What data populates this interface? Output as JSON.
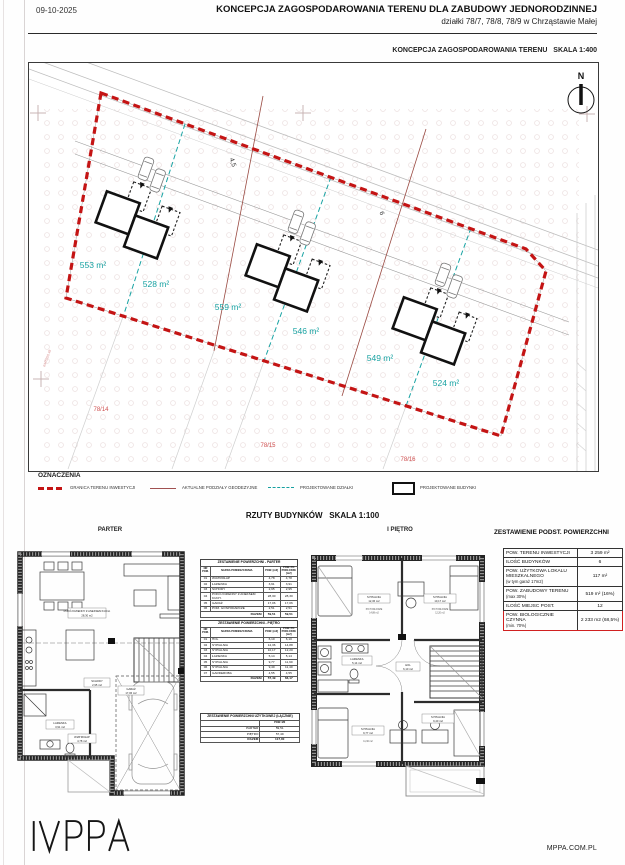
{
  "header": {
    "date": "09-10-2025",
    "title": "KONCEPCJA ZAGOSPODAROWANIA TERENU DLA ZABUDOWY JEDNORODZINNEJ",
    "subtitle": "działki 78/7, 78/8, 78/9  w Chrząstawie Małej"
  },
  "site_plan": {
    "caption": "KONCEPCJA ZAGOSPODAROWANIA TERENU",
    "scale": "SKALA 1:400",
    "north_label": "N",
    "plot_areas": [
      "553 m²",
      "528 m²",
      "559 m²",
      "546 m²",
      "549 m²",
      "524 m²"
    ],
    "parcel_labels": [
      "78/14",
      "78/15",
      "78/16"
    ],
    "dimensions": [
      "4,5",
      "6"
    ],
    "survey_coord": "6445250.48"
  },
  "legend": {
    "title": "OZNACZENIA",
    "items": [
      {
        "label": "GRANICA TERENU INWESTYCJI"
      },
      {
        "label": "AKTUALNE PODZIAŁY GEODEZYJNE"
      },
      {
        "label": "PROJEKTOWANE DZIAŁKI"
      },
      {
        "label": "PROJEKTOWANE BUDYNKI"
      }
    ]
  },
  "floor_plans": {
    "section_title": "RZUTY BUDYNKÓW",
    "scale": "SKALA 1:100",
    "left_title": "PARTER",
    "right_title": "I PIĘTRO",
    "parter_labels": [
      {
        "name": "POKÓJ DZIENNY Z ANEKSEM KUCH.",
        "area": "28,30 m2"
      },
      {
        "name": "SCHODY",
        "area": "2,95 m2"
      },
      {
        "name": "ŁAZIENKA",
        "area": "3,91 m2"
      },
      {
        "name": "WIATROŁAP",
        "area": "4,78 m2"
      },
      {
        "name": "GARAŻ",
        "area": "17,06 m2"
      }
    ],
    "pietro_labels": [
      {
        "name": "SYPIALNIA",
        "area": "12,36 m2",
        "sub1": "PO PODŁODZE",
        "sub2": "14,88 m2"
      },
      {
        "name": "SYPIALNIA",
        "area": "10,17 m2",
        "sub1": "PO PODŁODZE",
        "sub2": "12,20 m2"
      },
      {
        "name": "ŁAZIENKA",
        "area": "5,14 m2",
        "sub1": "",
        "sub2": ""
      },
      {
        "name": "HOL",
        "area": "6,10 m2",
        "sub1": "",
        "sub2": ""
      },
      {
        "name": "SYPIALNIA",
        "area": "9,77 m2",
        "sub1": "PO PODŁODZE",
        "sub2": "11,90 m2"
      },
      {
        "name": "SYPIALNIA",
        "area": "9,40 m2",
        "sub1": "PO PODŁODZE",
        "sub2": "11,40 m2"
      }
    ]
  },
  "room_tables": {
    "parter": {
      "title": "ZESTAWIENIE POWIERZCHNI - PARTER",
      "columns": [
        "NR POM.",
        "NAZWA POMIESZCZENIA",
        "POW. [m2]",
        "POW. PO PODŁODZE [m2]"
      ],
      "rows": [
        [
          "01",
          "WIATROŁAP",
          "4,78",
          "4,78"
        ],
        [
          "02",
          "ŁAZIENKA",
          "3,91",
          "3,91"
        ],
        [
          "03",
          "SCHODY",
          "2,95",
          "2,95"
        ],
        [
          "04",
          "POKÓJ DZIENNY Z ANEKSEM KUCH.",
          "28,30",
          "28,30"
        ],
        [
          "05",
          "GARAŻ",
          "17,06",
          "17,06"
        ],
        [
          "06",
          "POM. GOSPODARCZE",
          "2,51",
          "2,51"
        ]
      ],
      "total_label": "RAZEM",
      "total": [
        "59,51",
        "59,51"
      ]
    },
    "pietro": {
      "title": "ZESTAWIENIE POWIERZCHNI - PIĘTRO",
      "columns": [
        "NR POM.",
        "NAZWA POMIESZCZENIA",
        "POW. [m2]",
        "POW. PO PODŁODZE [m2]"
      ],
      "rows": [
        [
          "01",
          "HOL",
          "6,10",
          "6,10"
        ],
        [
          "02",
          "SYPIALNIA",
          "12,36",
          "14,88"
        ],
        [
          "03",
          "SYPIALNIA",
          "10,17",
          "12,20"
        ],
        [
          "04",
          "ŁAZIENKA",
          "5,14",
          "5,14"
        ],
        [
          "05",
          "SYPIALNIA",
          "9,77",
          "11,90"
        ],
        [
          "06",
          "SYPIALNIA",
          "9,40",
          "11,40"
        ],
        [
          "07",
          "GARDEROBA",
          "4,55",
          "4,55"
        ]
      ],
      "total_label": "RAZEM",
      "total": [
        "57,49",
        "66,17"
      ]
    },
    "combined": {
      "title": "ZESTAWIENIE POWIERZCHNI UŻYTKOWEJ (ŁĄCZNIE)",
      "value_header": "POW. M2",
      "rows": [
        [
          "PARTER",
          "59,51"
        ],
        [
          "PIĘTRO",
          "57,49"
        ],
        [
          "RAZEM",
          "117,00"
        ]
      ]
    }
  },
  "summary_table": {
    "title": "ZESTAWIENIE PODST. POWIERZCHNI",
    "rows": [
      {
        "label": "POW. TERENU INWESTYCJI",
        "note": "",
        "value": "3 259 m²"
      },
      {
        "label": "ILOŚĆ BUDYNKÓW",
        "note": "",
        "value": "6"
      },
      {
        "label": "POW. UŻYTKOWA LOKALU MIESZKALNEGO",
        "note": "(w tym garaż 17m2)",
        "value": "117 m²"
      },
      {
        "label": "POW. ZABUDOWY TERENU",
        "note": "(max 30%)",
        "value": "519 m² (16%)"
      },
      {
        "label": "ILOŚĆ MIEJSC POST.",
        "note": "",
        "value": "12"
      },
      {
        "label": "POW. BIOLOGICZNIE CZYNNA",
        "note": "(min. 70%)",
        "value": "2 233 m2 (68,5%)"
      }
    ]
  },
  "footer": {
    "logo": "MPPA",
    "website": "MPPA.COM.PL"
  },
  "colors": {
    "boundary_red": "#c41414",
    "plot_teal": "#17a2a2",
    "division_brown": "#9a4a42",
    "parcel_red": "#cf4f4f",
    "highlight_red": "#d02020"
  }
}
